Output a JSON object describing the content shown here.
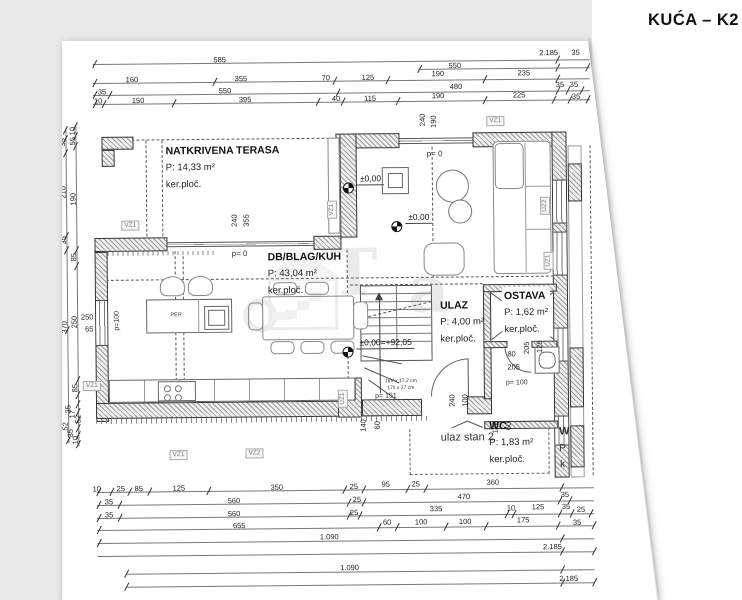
{
  "title": "KUĆA – K2",
  "rooms": [
    {
      "name": "NATKRIVENA TERASA",
      "area": "P: 14,33 m²",
      "floor": "ker.ploč.",
      "x": 167,
      "y": 143
    },
    {
      "name": "DB/BLAG/KUH",
      "area": "P: 43,04 m²",
      "floor": "ker.ploč.",
      "x": 268,
      "y": 250
    },
    {
      "name": "ULAZ",
      "area": "P: 4,00 m²",
      "floor": "ker.ploč.",
      "x": 440,
      "y": 300
    },
    {
      "name": "OSTAVA",
      "area": "P: 1,62 m²",
      "floor": "ker.ploč.",
      "x": 502,
      "y": 291,
      "bg": true
    },
    {
      "name": "WC",
      "area": "P: 1,83 m²",
      "floor": "ker.ploč.",
      "x": 488,
      "y": 421
    }
  ],
  "elevations": [
    {
      "label": "±0,00",
      "mx": 344,
      "my": 185,
      "lx": 358,
      "ly": 176
    },
    {
      "label": "±0,00",
      "mx": 392,
      "my": 224,
      "lx": 406,
      "ly": 215
    },
    {
      "label": "±0,00=+92,05",
      "mx": 342,
      "my": 349,
      "lx": 356,
      "ly": 340
    }
  ],
  "wall_tags": [
    {
      "t": "VZ1",
      "x": 131,
      "y": 226
    },
    {
      "t": "VZ1",
      "x": 91,
      "y": 386
    },
    {
      "t": "VZ1",
      "x": 497,
      "y": 125
    },
    {
      "t": "VZ1",
      "x": 333,
      "y": 212,
      "r": 1
    },
    {
      "t": "VZ1",
      "x": 177,
      "y": 456
    },
    {
      "t": "VZ2",
      "x": 253,
      "y": 455
    },
    {
      "t": "UZ1",
      "x": 342,
      "y": 401,
      "r": 1
    },
    {
      "t": "UZ2",
      "x": 546,
      "y": 210,
      "r": 1
    },
    {
      "t": "UZ1",
      "x": 549,
      "y": 265,
      "r": 1
    }
  ],
  "dims": [
    [
      "585",
      222,
      61
    ],
    [
      "2.185",
      551,
      57
    ],
    [
      "35",
      578,
      57
    ],
    [
      "550",
      457,
      69
    ],
    [
      "160",
      134,
      80
    ],
    [
      "355",
      243,
      80
    ],
    [
      "70",
      328,
      80
    ],
    [
      "125",
      370,
      80
    ],
    [
      "190",
      440,
      77
    ],
    [
      "235",
      526,
      77
    ],
    [
      "35",
      104,
      92
    ],
    [
      "550",
      227,
      92
    ],
    [
      "480",
      458,
      90
    ],
    [
      "35",
      562,
      89
    ],
    [
      "35",
      576,
      89
    ],
    [
      "10",
      100,
      101
    ],
    [
      "150",
      140,
      101
    ],
    [
      "395",
      247,
      101
    ],
    [
      "40",
      338,
      101
    ],
    [
      "115",
      372,
      101
    ],
    [
      "190",
      440,
      99
    ],
    [
      "225",
      521,
      99
    ],
    [
      "35",
      578,
      101
    ],
    [
      "737",
      30,
      287,
      1
    ],
    [
      "64",
      41,
      152,
      1
    ],
    [
      "180",
      41,
      203,
      1
    ],
    [
      "492",
      41,
      338,
      1
    ],
    [
      "244",
      53,
      186,
      1
    ],
    [
      "95",
      53,
      258,
      1
    ],
    [
      "95",
      53,
      399,
      1
    ],
    [
      "35",
      64,
      142,
      1
    ],
    [
      "210",
      64,
      192,
      1
    ],
    [
      "35",
      64,
      240,
      1
    ],
    [
      "370",
      64,
      327,
      1
    ],
    [
      "10",
      74,
      131,
      1
    ],
    [
      "55",
      74,
      141,
      1
    ],
    [
      "190",
      74,
      199,
      1
    ],
    [
      "85",
      74,
      257,
      1
    ],
    [
      "250",
      74,
      322,
      1
    ],
    [
      "85",
      74,
      388,
      1
    ],
    [
      "35",
      67,
      409,
      1
    ],
    [
      "17",
      71,
      414,
      1
    ],
    [
      "52",
      77,
      419,
      1
    ],
    [
      "52",
      64,
      426,
      1
    ],
    [
      "35",
      69,
      433,
      1
    ],
    [
      "10",
      74,
      440,
      1
    ],
    [
      "250",
      87,
      317
    ],
    [
      "65",
      89,
      329
    ],
    [
      "240",
      235,
      222,
      1
    ],
    [
      "355",
      247,
      222,
      1
    ],
    [
      "240",
      424,
      123,
      1
    ],
    [
      "190",
      435,
      125,
      1
    ],
    [
      "140",
      362,
      428,
      1
    ],
    [
      "60",
      376,
      428,
      1
    ],
    [
      "240",
      451,
      404,
      1
    ],
    [
      "100",
      464,
      404,
      1
    ],
    [
      "120",
      494,
      431,
      1
    ],
    [
      "60",
      507,
      430,
      1
    ],
    [
      "205",
      526,
      352,
      1
    ],
    [
      "125",
      539,
      351,
      1
    ],
    [
      "80",
      511,
      358
    ],
    [
      "205",
      513,
      371
    ],
    [
      "10",
      95,
      489
    ],
    [
      "25",
      119,
      489
    ],
    [
      "85",
      137,
      489
    ],
    [
      "125",
      177,
      489
    ],
    [
      "350",
      275,
      489
    ],
    [
      "25",
      352,
      489
    ],
    [
      "95",
      384,
      487
    ],
    [
      "25",
      414,
      487
    ],
    [
      "360",
      491,
      486
    ],
    [
      "35",
      107,
      502
    ],
    [
      "560",
      232,
      502
    ],
    [
      "25",
      355,
      502
    ],
    [
      "470",
      462,
      500
    ],
    [
      "35",
      563,
      499
    ],
    [
      "35",
      107,
      515
    ],
    [
      "560",
      232,
      515
    ],
    [
      "25",
      352,
      515
    ],
    [
      "335",
      434,
      512
    ],
    [
      "10",
      509,
      512
    ],
    [
      "125",
      536,
      511
    ],
    [
      "35",
      564,
      511
    ],
    [
      "25",
      579,
      514
    ],
    [
      "655",
      237,
      527
    ],
    [
      "60",
      385,
      525
    ],
    [
      "100",
      419,
      525
    ],
    [
      "100",
      463,
      525
    ],
    [
      "175",
      521,
      524
    ],
    [
      "35",
      575,
      527
    ],
    [
      "1.090",
      327,
      539
    ],
    [
      "2.185",
      550,
      551
    ],
    [
      "1.090",
      347,
      570
    ],
    [
      "2.185",
      566,
      583
    ]
  ],
  "tick_rows": [
    {
      "y": 64,
      "xs": [
        97,
        560
      ]
    },
    {
      "y": 72,
      "xs": [
        422,
        560,
        590
      ]
    },
    {
      "y": 83,
      "xs": [
        97,
        217,
        337,
        390,
        487,
        560
      ]
    },
    {
      "y": 95,
      "xs": [
        97,
        112,
        340,
        560,
        570,
        584
      ]
    },
    {
      "y": 104,
      "xs": [
        97,
        106,
        176,
        320,
        345,
        400,
        487,
        556,
        572,
        590
      ]
    },
    {
      "y": 492,
      "xs": [
        97,
        110,
        128,
        148,
        207,
        343,
        362,
        406,
        424,
        560
      ]
    },
    {
      "y": 505,
      "xs": [
        97,
        118,
        347,
        362,
        558,
        568
      ]
    },
    {
      "y": 518,
      "xs": [
        97,
        118,
        347,
        358,
        505,
        512,
        558,
        570,
        589
      ]
    },
    {
      "y": 530,
      "xs": [
        97,
        377,
        395,
        444,
        484,
        556,
        592
      ]
    },
    {
      "y": 543,
      "xs": [
        97,
        560
      ]
    },
    {
      "y": 556,
      "xs": [
        560,
        592
      ]
    },
    {
      "y": 574,
      "xs": [
        124,
        560
      ]
    },
    {
      "y": 587,
      "xs": [
        124,
        560,
        592
      ]
    }
  ],
  "tick_cols": [
    {
      "x": 33,
      "ys": [
        131,
        490
      ]
    },
    {
      "x": 44,
      "ys": [
        130,
        157,
        200,
        488
      ]
    },
    {
      "x": 56,
      "ys": [
        130,
        167,
        212,
        258,
        399
      ]
    },
    {
      "x": 67,
      "ys": [
        130,
        139,
        153,
        236,
        250,
        330,
        440
      ]
    },
    {
      "x": 77,
      "ys": [
        126,
        136,
        146,
        250,
        266,
        380,
        395,
        404,
        412,
        420,
        428,
        435,
        444
      ]
    }
  ],
  "notes": [
    {
      "t": "ulaz stan 2",
      "x": 466,
      "y": 441,
      "s": 11
    },
    {
      "t": "p= 0",
      "x": 240,
      "y": 255,
      "s": 8
    },
    {
      "t": "p= 0",
      "x": 436,
      "y": 157,
      "s": 8
    },
    {
      "t": "p= 100",
      "x": 516,
      "y": 387,
      "s": 7
    },
    {
      "t": "p= 151",
      "x": 385,
      "y": 399,
      "s": 7
    },
    {
      "t": "p=100",
      "x": 117,
      "y": 321,
      "s": 7,
      "r": 1
    },
    {
      "t": "PER",
      "x": 176,
      "y": 316,
      "s": 5.5
    },
    {
      "t": "16V x 17,2 cm",
      "x": 400,
      "y": 384,
      "s": 5
    },
    {
      "t": "17š x 27 cm",
      "x": 400,
      "y": 391,
      "s": 5
    },
    {
      "t": "W",
      "x": 563,
      "y": 436,
      "s": 11,
      "b": 1
    },
    {
      "t": "P",
      "x": 561,
      "y": 453,
      "s": 10
    },
    {
      "t": "k",
      "x": 561,
      "y": 469,
      "s": 10
    }
  ],
  "watermark": {
    "letters": [
      "T",
      "a"
    ]
  }
}
